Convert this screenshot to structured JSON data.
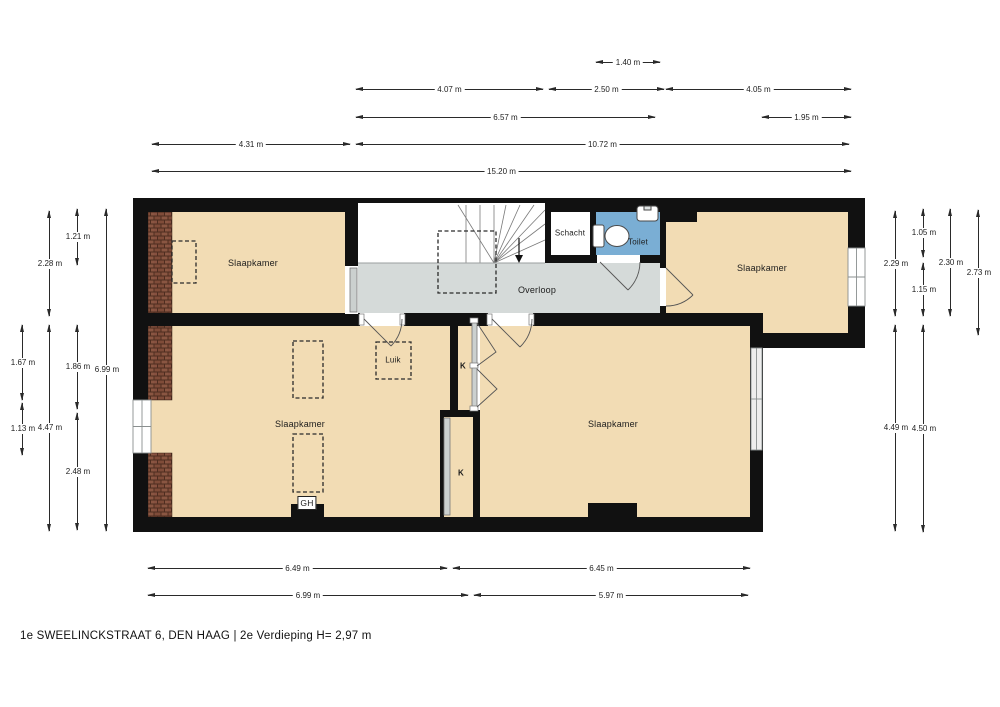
{
  "title": "1e SWEELINCKSTRAAT 6, DEN HAAG | 2e Verdieping H= 2,97 m",
  "floor_plan": {
    "rooms": [
      {
        "id": "slaapkamer-top-left",
        "label": "Slaapkamer",
        "x": 253,
        "y": 263,
        "kind": "room"
      },
      {
        "id": "slaapkamer-top-right",
        "label": "Slaapkamer",
        "x": 762,
        "y": 268,
        "kind": "room"
      },
      {
        "id": "slaapkamer-bottom-left",
        "label": "Slaapkamer",
        "x": 300,
        "y": 424,
        "kind": "room"
      },
      {
        "id": "slaapkamer-bottom-right",
        "label": "Slaapkamer",
        "x": 613,
        "y": 424,
        "kind": "room"
      },
      {
        "id": "overloop",
        "label": "Overloop",
        "x": 537,
        "y": 290,
        "kind": "room"
      },
      {
        "id": "schacht",
        "label": "Schacht",
        "x": 570,
        "y": 233,
        "kind": "fixture"
      },
      {
        "id": "toilet",
        "label": "Toilet",
        "x": 638,
        "y": 242,
        "kind": "fixture"
      },
      {
        "id": "luik",
        "label": "Luik",
        "x": 393,
        "y": 360,
        "kind": "fixture"
      },
      {
        "id": "kast-upper",
        "label": "K",
        "x": 463,
        "y": 366,
        "kind": "small"
      },
      {
        "id": "kast-lower",
        "label": "K",
        "x": 461,
        "y": 473,
        "kind": "small"
      },
      {
        "id": "geiser",
        "label": "GH",
        "x": 307,
        "y": 503,
        "kind": "boxed"
      }
    ],
    "dimensions_horizontal": [
      {
        "label": "1.40 m",
        "x1": 596,
        "x2": 660,
        "y": 62
      },
      {
        "label": "4.07 m",
        "x1": 356,
        "x2": 543,
        "y": 89
      },
      {
        "label": "2.50 m",
        "x1": 549,
        "x2": 664,
        "y": 89
      },
      {
        "label": "4.05 m",
        "x1": 666,
        "x2": 851,
        "y": 89
      },
      {
        "label": "6.57 m",
        "x1": 356,
        "x2": 655,
        "y": 117
      },
      {
        "label": "1.95 m",
        "x1": 762,
        "x2": 851,
        "y": 117
      },
      {
        "label": "4.31 m",
        "x1": 152,
        "x2": 350,
        "y": 144
      },
      {
        "label": "10.72 m",
        "x1": 356,
        "x2": 849,
        "y": 144
      },
      {
        "label": "15.20 m",
        "x1": 152,
        "x2": 851,
        "y": 171
      },
      {
        "label": "6.49 m",
        "x1": 148,
        "x2": 447,
        "y": 568
      },
      {
        "label": "6.45 m",
        "x1": 453,
        "x2": 750,
        "y": 568
      },
      {
        "label": "6.99 m",
        "x1": 148,
        "x2": 468,
        "y": 595
      },
      {
        "label": "5.97 m",
        "x1": 474,
        "x2": 748,
        "y": 595
      }
    ],
    "dimensions_vertical": [
      {
        "label": "1.67 m",
        "x": 22,
        "y1": 325,
        "y2": 400
      },
      {
        "label": "1.13 m",
        "x": 22,
        "y1": 403,
        "y2": 455
      },
      {
        "label": "2.28 m",
        "x": 49,
        "y1": 211,
        "y2": 316
      },
      {
        "label": "4.47 m",
        "x": 49,
        "y1": 325,
        "y2": 531
      },
      {
        "label": "1.21 m",
        "x": 77,
        "y1": 209,
        "y2": 265
      },
      {
        "label": "1.86 m",
        "x": 77,
        "y1": 325,
        "y2": 409
      },
      {
        "label": "2.48 m",
        "x": 77,
        "y1": 413,
        "y2": 530
      },
      {
        "label": "6.99 m",
        "x": 106,
        "y1": 209,
        "y2": 531
      },
      {
        "label": "2.29 m",
        "x": 895,
        "y1": 211,
        "y2": 316
      },
      {
        "label": "4.49 m",
        "x": 895,
        "y1": 325,
        "y2": 531
      },
      {
        "label": "1.05 m",
        "x": 923,
        "y1": 209,
        "y2": 257
      },
      {
        "label": "1.15 m",
        "x": 923,
        "y1": 263,
        "y2": 316
      },
      {
        "label": "4.50 m",
        "x": 923,
        "y1": 325,
        "y2": 532
      },
      {
        "label": "2.30 m",
        "x": 950,
        "y1": 209,
        "y2": 316
      },
      {
        "label": "2.73 m",
        "x": 978,
        "y1": 210,
        "y2": 335
      }
    ],
    "colors": {
      "floor": "#f2dcb4",
      "landing": "#d5dad9",
      "toilet_room": "#7aaed4",
      "wall": "#111111",
      "brick": "#7d4a37",
      "dashed": "#2a2a2a"
    }
  }
}
